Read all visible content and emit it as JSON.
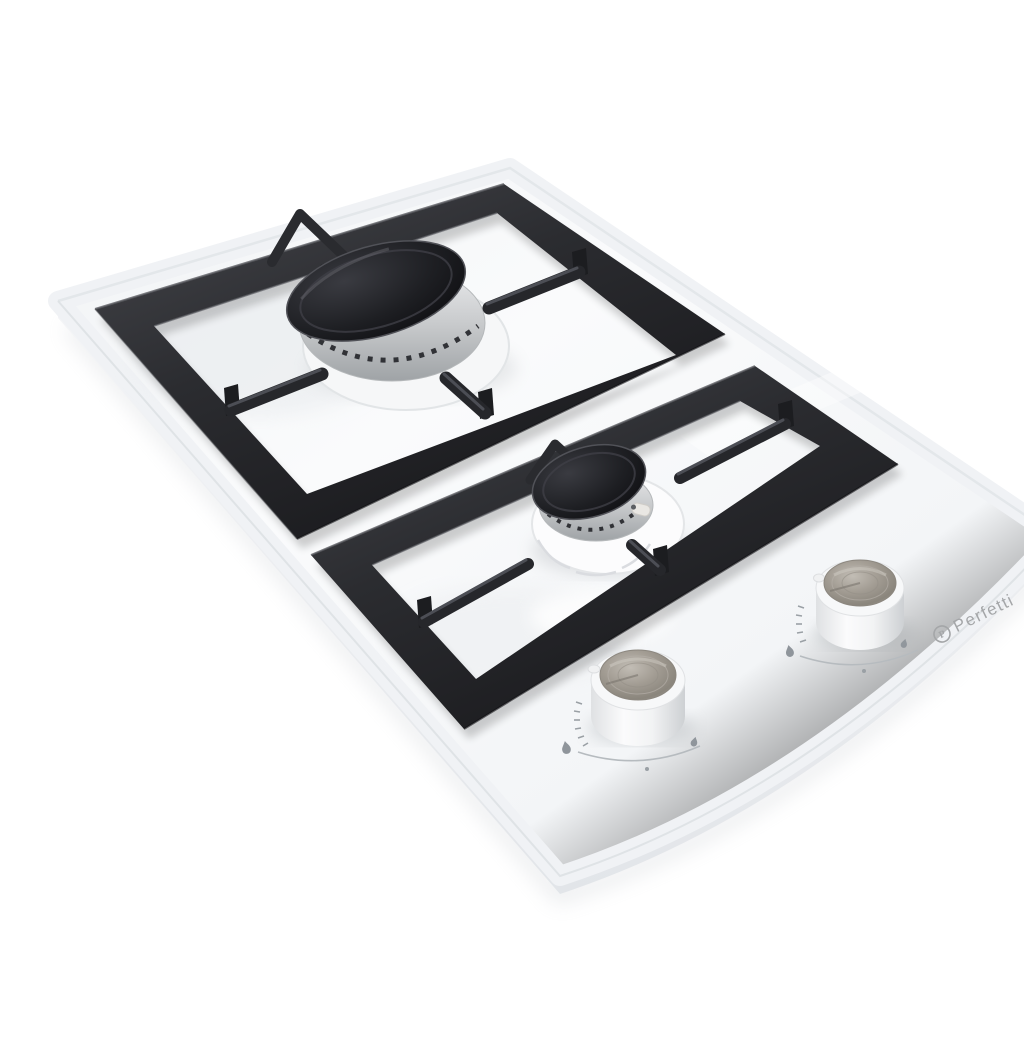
{
  "photo": {
    "type": "product-photo",
    "subject": "Two-burner domino gas hob: white tempered-glass top, black cast-iron pan supports, angled top view",
    "background_color": "#ffffff",
    "surface_color": "#f5f7f9",
    "grate_color": "#2b2c30",
    "burner_cap_color": "#151518",
    "chrome_ring_color": "#c9cbcd",
    "knob_body_color": "#f6f7f8",
    "knob_cap_color": "#a29c93",
    "marking_color": "#8f959b"
  },
  "brand": {
    "name": "Perfetti",
    "logo_letter": "P",
    "color": "#a4a6a8"
  },
  "burners": [
    {
      "id": "rear-large-burner",
      "size": "large"
    },
    {
      "id": "front-small-burner",
      "size": "small"
    }
  ],
  "knobs": [
    {
      "id": "front-knob",
      "markings": [
        "tick-scale",
        "large-flame",
        "small-flame",
        "off-dot"
      ]
    },
    {
      "id": "rear-knob",
      "markings": [
        "tick-scale",
        "large-flame",
        "small-flame",
        "off-dot"
      ]
    }
  ]
}
